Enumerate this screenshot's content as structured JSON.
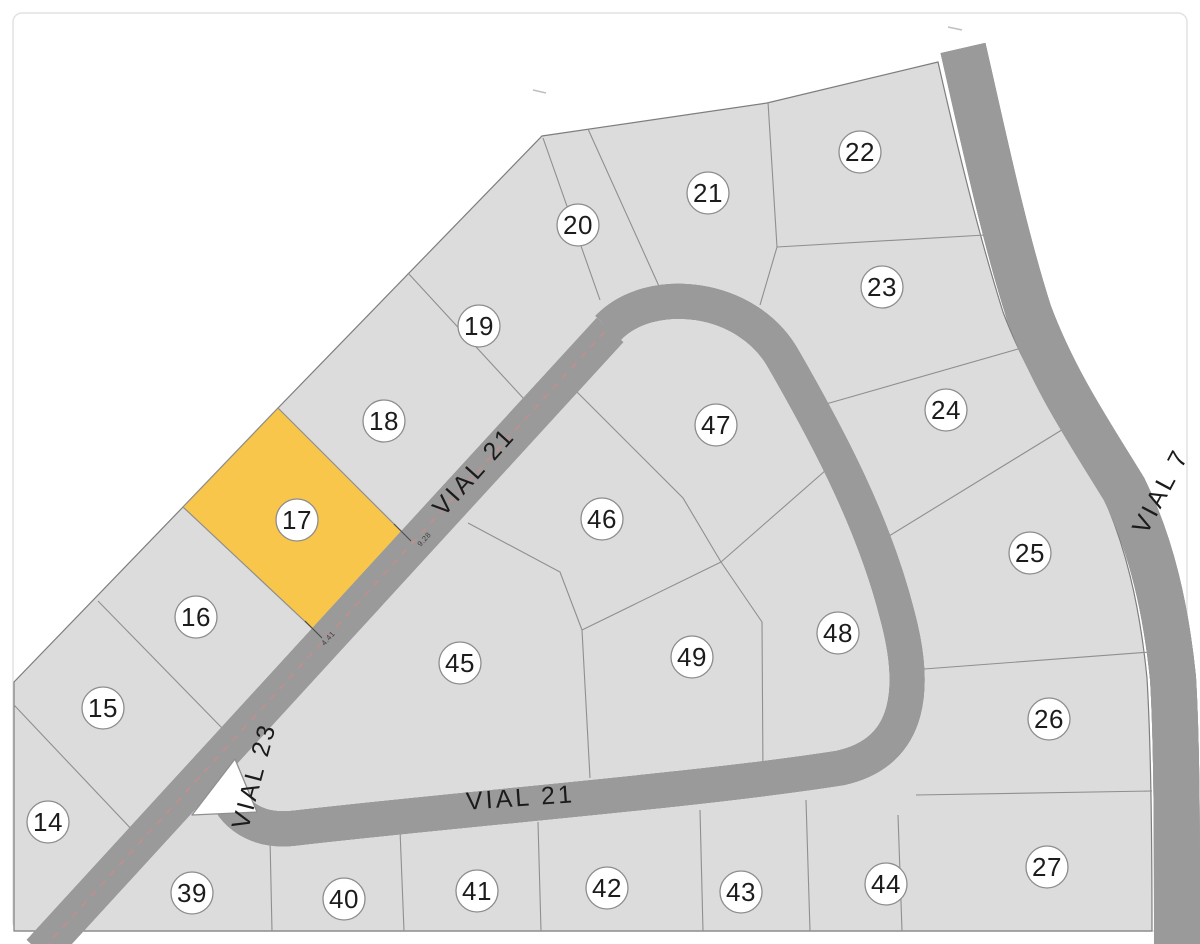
{
  "map": {
    "title": "Residential plots plan",
    "colors": {
      "background": "#ffffff",
      "parcel_fill": "#dcdcdd",
      "parcel_stroke": "#8f8f8f",
      "highlight_fill": "#f7c64a",
      "road_fill": "#ffffff",
      "road_casing": "#9a9a9a",
      "centerline_red": "#c98c8c",
      "label_text": "#1c1c1c"
    },
    "highlighted_parcel": "17",
    "parcels": [
      {
        "number": "14",
        "x": 48,
        "y": 822,
        "highlighted": false
      },
      {
        "number": "15",
        "x": 103,
        "y": 708,
        "highlighted": false
      },
      {
        "number": "16",
        "x": 196,
        "y": 617,
        "highlighted": false
      },
      {
        "number": "17",
        "x": 297,
        "y": 520,
        "highlighted": true
      },
      {
        "number": "18",
        "x": 384,
        "y": 421,
        "highlighted": false
      },
      {
        "number": "19",
        "x": 479,
        "y": 326,
        "highlighted": false
      },
      {
        "number": "20",
        "x": 578,
        "y": 225,
        "highlighted": false
      },
      {
        "number": "21",
        "x": 708,
        "y": 193,
        "highlighted": false
      },
      {
        "number": "22",
        "x": 860,
        "y": 152,
        "highlighted": false
      },
      {
        "number": "23",
        "x": 882,
        "y": 287,
        "highlighted": false
      },
      {
        "number": "24",
        "x": 946,
        "y": 410,
        "highlighted": false
      },
      {
        "number": "25",
        "x": 1030,
        "y": 553,
        "highlighted": false
      },
      {
        "number": "26",
        "x": 1049,
        "y": 719,
        "highlighted": false
      },
      {
        "number": "27",
        "x": 1047,
        "y": 867,
        "highlighted": false
      },
      {
        "number": "39",
        "x": 192,
        "y": 893,
        "highlighted": false
      },
      {
        "number": "40",
        "x": 344,
        "y": 899,
        "highlighted": false
      },
      {
        "number": "41",
        "x": 477,
        "y": 891,
        "highlighted": false
      },
      {
        "number": "42",
        "x": 607,
        "y": 888,
        "highlighted": false
      },
      {
        "number": "43",
        "x": 741,
        "y": 892,
        "highlighted": false
      },
      {
        "number": "44",
        "x": 886,
        "y": 884,
        "highlighted": false
      },
      {
        "number": "45",
        "x": 460,
        "y": 663,
        "highlighted": false
      },
      {
        "number": "46",
        "x": 602,
        "y": 519,
        "highlighted": false
      },
      {
        "number": "47",
        "x": 716,
        "y": 425,
        "highlighted": false
      },
      {
        "number": "48",
        "x": 838,
        "y": 633,
        "highlighted": false
      },
      {
        "number": "49",
        "x": 692,
        "y": 657,
        "highlighted": false
      }
    ],
    "road_labels": [
      {
        "text": "VIAL 21",
        "x": 480,
        "y": 477,
        "rotation": -48,
        "size": 25
      },
      {
        "text": "VIAL 21",
        "x": 521,
        "y": 806,
        "rotation": -4,
        "size": 25
      },
      {
        "text": "VIAL 23",
        "x": 262,
        "y": 778,
        "rotation": -75,
        "size": 22
      },
      {
        "text": "VIAL 7",
        "x": 1168,
        "y": 495,
        "rotation": -62,
        "size": 24
      }
    ],
    "frontage_dimensions": [
      {
        "text": "9.28",
        "x": 426,
        "y": 541,
        "rotation": -48
      },
      {
        "text": "4.41",
        "x": 330,
        "y": 640,
        "rotation": -48
      }
    ]
  }
}
